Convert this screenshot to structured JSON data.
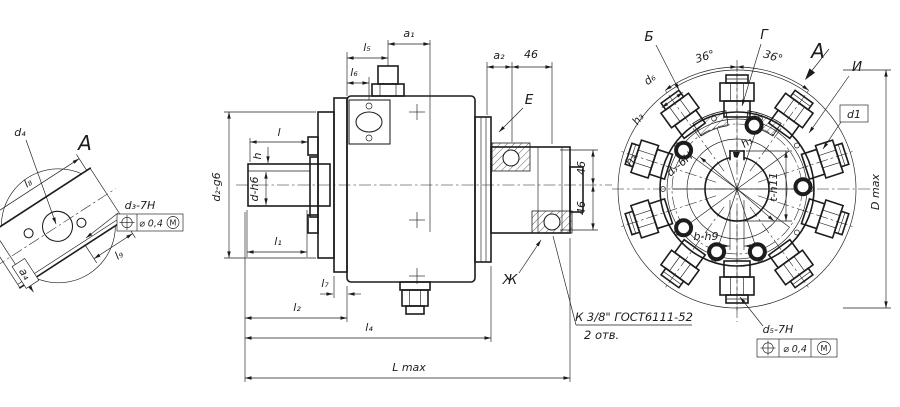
{
  "colors": {
    "ink": "#1c1c1c",
    "paper": "#ffffff"
  },
  "icons": {
    "position_tolerance": "circle-crosshair",
    "material_condition": "M-in-circle",
    "view_direction": "filled-arrow"
  },
  "view_a": {
    "title": "A",
    "dim_l8": "l₈",
    "dim_l9": "l₉",
    "dim_a4": "a₄",
    "label_d4": "d₄",
    "label_d3": "d₃-7H",
    "frame": {
      "value": "⌀ 0,4",
      "modifier": "M"
    }
  },
  "side_view": {
    "dim_a1": "a₁",
    "dim_l5": "l₅",
    "dim_l6": "l₆",
    "dim_a2": "a₂",
    "dim_46_top": "46",
    "dim_l": "l",
    "dim_h": "h",
    "dim_d_h6": "d-h6",
    "dim_d2_g6": "d₂-g6",
    "dim_l1": "l₁",
    "dim_l7": "l₇",
    "dim_l2": "l₂",
    "dim_l4": "l₄",
    "dim_L_max": "L max",
    "dim_46_right_top": "46",
    "dim_46_right_bottom": "46",
    "callout_E": "E",
    "callout_Zh": "Ж",
    "note_line1": "К 3/8\" ГОСТ6111-52",
    "note_line2": "2 отв."
  },
  "front_view": {
    "label_B": "Б",
    "label_G": "Г",
    "angle_left": "36°",
    "angle_right": "36°",
    "view_label": "A",
    "label_I": "И",
    "label_d1": "d1",
    "dim_d6": "d₆",
    "dim_h3_upper": "h₃",
    "dim_h3_lower": "h₃",
    "dim_h1": "h₁",
    "dim_d7": "d₇-6H",
    "dim_t": "t-h11",
    "dim_b": "b-h9",
    "dim_D_max": "D max",
    "label_d5": "d₅-7H",
    "frame": {
      "value": "⌀ 0,4",
      "modifier": "M"
    }
  }
}
